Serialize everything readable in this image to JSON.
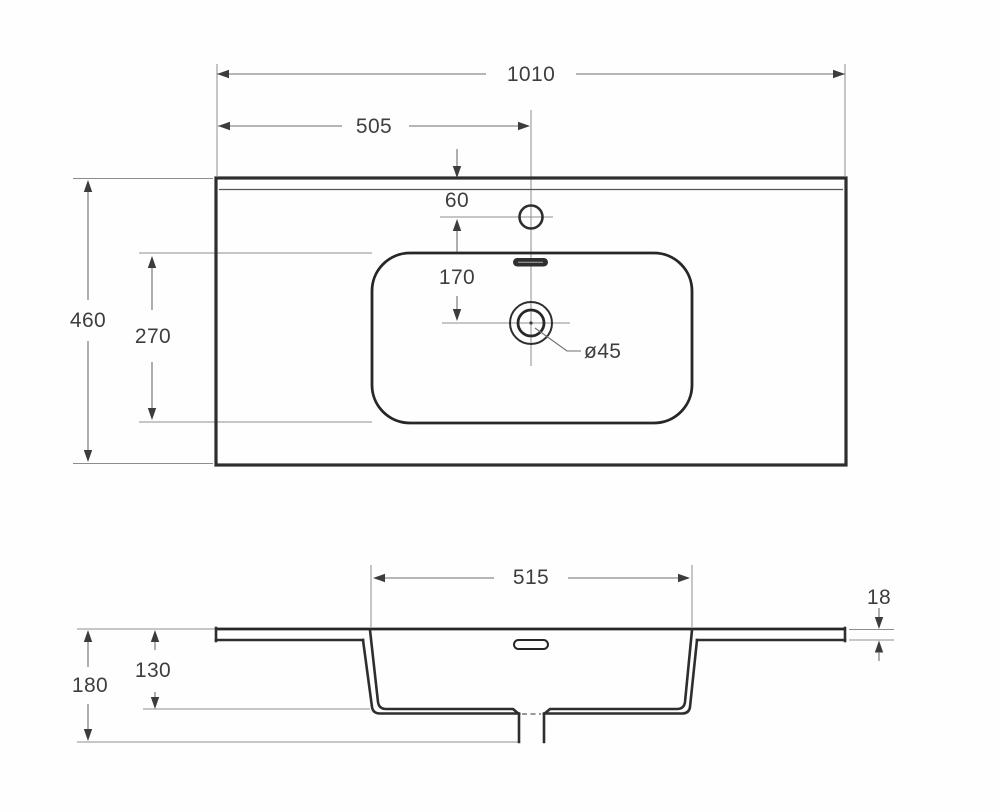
{
  "drawing": {
    "background_color": "#fefefe",
    "line_color": "#2e2e2e",
    "dim_line_color": "#6e6e6e",
    "text_color": "#3e3e3e",
    "dims": {
      "top": {
        "overall_width": "1010",
        "half_width": "505",
        "faucet_offset": "60",
        "faucet_to_drain": "170",
        "overall_depth": "460",
        "basin_depth": "270",
        "drain_diameter": "ø45"
      },
      "section": {
        "basin_width": "515",
        "rim_thickness": "18",
        "basin_height": "130",
        "overall_height": "180"
      }
    }
  }
}
